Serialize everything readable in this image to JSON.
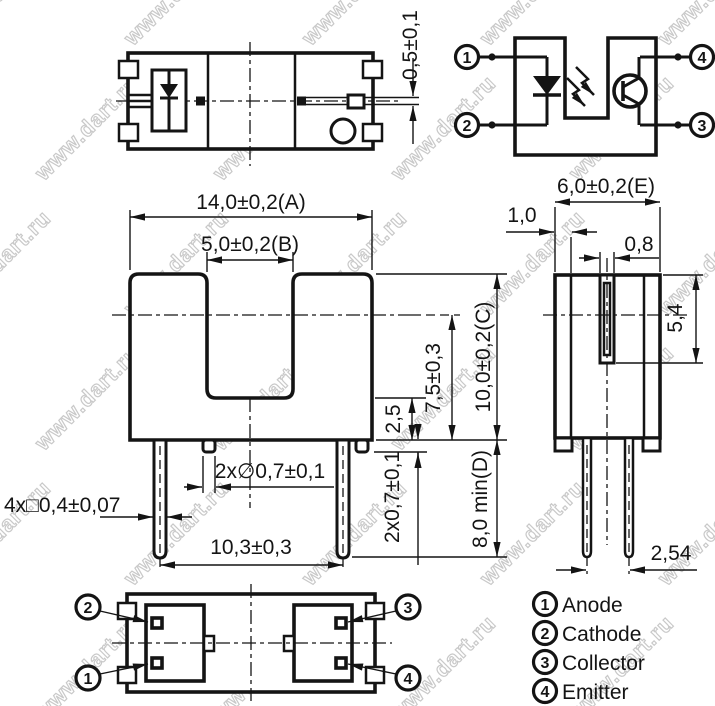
{
  "watermark": {
    "text": "www.dart.ru"
  },
  "top_view": {
    "dim_slit": "0,5±0,1"
  },
  "schematic": {
    "pin_top_left": "1",
    "pin_bottom_left": "2",
    "pin_top_right": "4",
    "pin_bottom_right": "3"
  },
  "front_view": {
    "dim_width": "14,0±0,2(A)",
    "dim_slot": "5,0±0,2(B)",
    "dim_center_to_base": "7,5±0,3",
    "dim_height": "10,0±0,2(C)",
    "dim_slot_base": "2,5",
    "dim_boss_height": "2x0,7±0,1",
    "dim_lead_length": "8,0 min(D)",
    "dim_lead_square": "4x□0,4±0,07",
    "dim_boss_dia": "2x∅0,7±0,1",
    "dim_lead_pitch": "10,3±0,3"
  },
  "side_view": {
    "dim_depth": "6,0±0,2(E)",
    "dim_wall": "1,0",
    "dim_aperture": "0,8",
    "dim_aperture_depth": "5,4",
    "dim_pin_pitch": "2,54"
  },
  "bottom_view": {
    "pin_top_left": "2",
    "pin_bottom_left": "1",
    "pin_top_right": "3",
    "pin_bottom_right": "4"
  },
  "legend": {
    "items": [
      {
        "num": "1",
        "label": "Anode"
      },
      {
        "num": "2",
        "label": "Cathode"
      },
      {
        "num": "3",
        "label": "Collector"
      },
      {
        "num": "4",
        "label": "Emitter"
      }
    ]
  }
}
